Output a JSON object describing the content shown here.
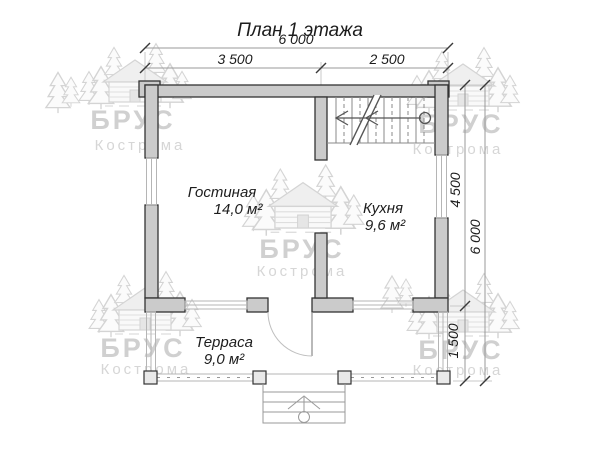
{
  "title": "План 1 этажа",
  "dimensions": {
    "top_total": "6 000",
    "top_left": "3 500",
    "top_right": "2 500",
    "right_upper": "4 500",
    "right_total": "6 000",
    "right_lower": "1 500"
  },
  "rooms": [
    {
      "name": "Гостиная",
      "area": "14,0 м²"
    },
    {
      "name": "Кухня",
      "area": "9,6 м²"
    },
    {
      "name": "Терраса",
      "area": "9,0 м²"
    }
  ],
  "watermark": {
    "brand": "БРУС",
    "city": "Кострома"
  },
  "icons": {
    "watermark_logo": "log-cabin-with-pine-trees",
    "stairs": "stair-treads-with-break-line-and-direction-arrow",
    "entrance": "steps-with-up-arrow"
  },
  "colors": {
    "background": "#ffffff",
    "wall_fill": "#cbcbcb",
    "wall_stroke": "#333333",
    "window_line": "#b5b5b5",
    "dimension_line": "#999999",
    "text": "#1c1c1c",
    "watermark": "#d2d2d2"
  }
}
